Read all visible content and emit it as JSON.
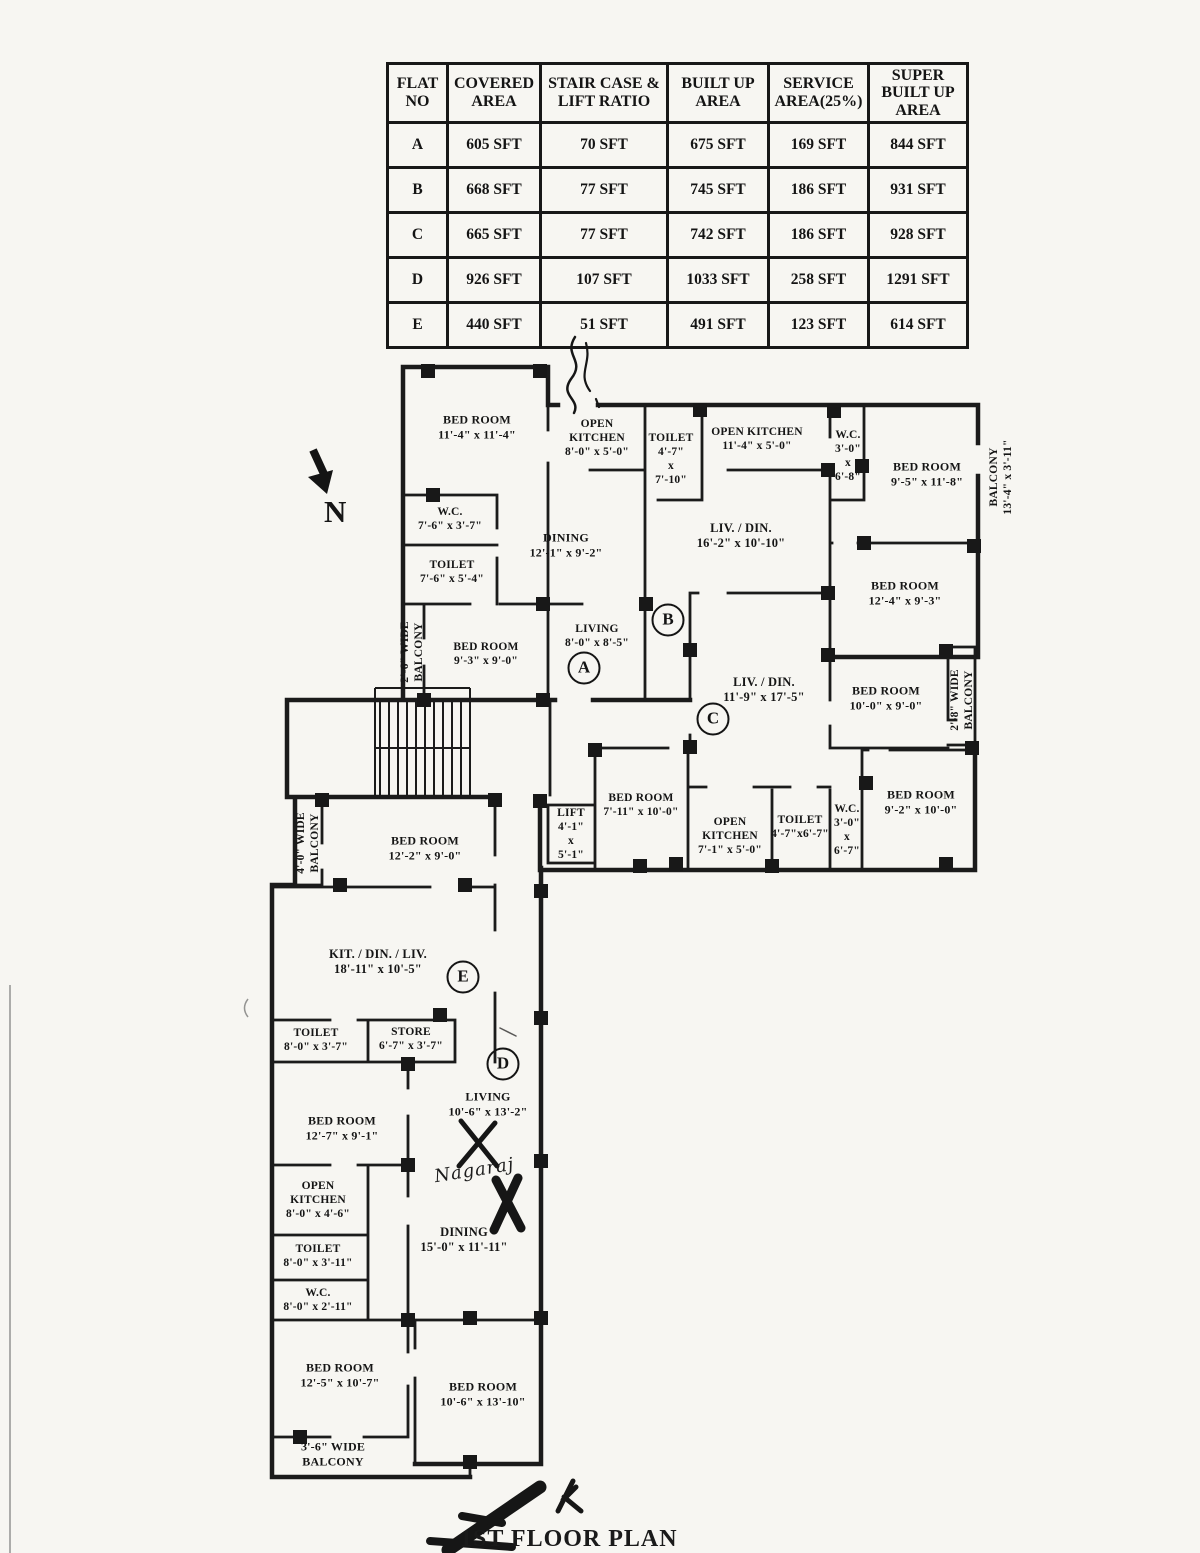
{
  "title": "1ST FLOOR PLAN",
  "compass": {
    "label": "N"
  },
  "annotations": {
    "signature": "Nagaraj"
  },
  "area_table": {
    "headers": [
      "FLAT NO",
      "COVERED AREA",
      "STAIR CASE & LIFT RATIO",
      "BUILT UP AREA",
      "SERVICE AREA(25%)",
      "SUPER BUILT UP AREA"
    ],
    "rows": [
      [
        "A",
        "605 SFT",
        "70 SFT",
        "675 SFT",
        "169 SFT",
        "844 SFT"
      ],
      [
        "B",
        "668 SFT",
        "77 SFT",
        "745 SFT",
        "186 SFT",
        "931 SFT"
      ],
      [
        "C",
        "665 SFT",
        "77 SFT",
        "742 SFT",
        "186 SFT",
        "928 SFT"
      ],
      [
        "D",
        "926 SFT",
        "107 SFT",
        "1033 SFT",
        "258 SFT",
        "1291 SFT"
      ],
      [
        "E",
        "440 SFT",
        "51 SFT",
        "491 SFT",
        "123 SFT",
        "614 SFT"
      ]
    ]
  },
  "flat_markers": [
    {
      "label": "A",
      "x": 584,
      "y": 668
    },
    {
      "label": "B",
      "x": 668,
      "y": 620
    },
    {
      "label": "C",
      "x": 713,
      "y": 719
    },
    {
      "label": "D",
      "x": 503,
      "y": 1064
    },
    {
      "label": "E",
      "x": 463,
      "y": 977
    }
  ],
  "rooms": [
    {
      "lines": [
        "BED ROOM",
        "11'-4\" x 11'-4\""
      ],
      "x": 477,
      "y": 427,
      "fs": 12
    },
    {
      "lines": [
        "OPEN",
        "KITCHEN",
        "8'-0\" x 5'-0\""
      ],
      "x": 597,
      "y": 438
    },
    {
      "lines": [
        "W.C.",
        "7'-6\" x 3'-7\""
      ],
      "x": 450,
      "y": 519
    },
    {
      "lines": [
        "TOILET",
        "7'-6\" x 5'-4\""
      ],
      "x": 452,
      "y": 572
    },
    {
      "lines": [
        "DINING",
        "12'-1\" x 9'-2\""
      ],
      "x": 566,
      "y": 545,
      "fs": 12
    },
    {
      "lines": [
        "2'-6\" WIDE",
        "BALCONY"
      ],
      "x": 412,
      "y": 652,
      "vert": true
    },
    {
      "lines": [
        "BED ROOM",
        "9'-3\" x 9'-0\""
      ],
      "x": 486,
      "y": 654
    },
    {
      "lines": [
        "LIVING",
        "8'-0\" x 8'-5\""
      ],
      "x": 597,
      "y": 636
    },
    {
      "lines": [
        "TOILET",
        "4'-7\"",
        "x",
        "7'-10\""
      ],
      "x": 671,
      "y": 459
    },
    {
      "lines": [
        "OPEN KITCHEN",
        "11'-4\" x 5'-0\""
      ],
      "x": 757,
      "y": 439
    },
    {
      "lines": [
        "W.C.",
        "3'-0\"",
        "x",
        "6'-8\""
      ],
      "x": 848,
      "y": 456
    },
    {
      "lines": [
        "BED ROOM",
        "9'-5\" x 11'-8\""
      ],
      "x": 927,
      "y": 474,
      "fs": 12
    },
    {
      "lines": [
        "BALCONY",
        "13'-4\" x 3'-11\""
      ],
      "x": 1001,
      "y": 477,
      "vert": true
    },
    {
      "lines": [
        "LIV. / DIN.",
        "16'-2\" x 10'-10\""
      ],
      "x": 741,
      "y": 536,
      "fs": 12.5
    },
    {
      "lines": [
        "BED ROOM",
        "12'-4\" x 9'-3\""
      ],
      "x": 905,
      "y": 593,
      "fs": 12
    },
    {
      "lines": [
        "LIV. / DIN.",
        "11'-9\" x 17'-5\""
      ],
      "x": 764,
      "y": 690,
      "fs": 12.5
    },
    {
      "lines": [
        "BED ROOM",
        "10'-0\" x 9'-0\""
      ],
      "x": 886,
      "y": 698,
      "fs": 12
    },
    {
      "lines": [
        "2'-8\" WIDE",
        "BALCONY"
      ],
      "x": 962,
      "y": 700,
      "vert": true
    },
    {
      "lines": [
        "BED ROOM",
        "9'-2\" x 10'-0\""
      ],
      "x": 921,
      "y": 802,
      "fs": 12
    },
    {
      "lines": [
        "W.C.",
        "3'-0\"",
        "x",
        "6'-7\""
      ],
      "x": 847,
      "y": 830
    },
    {
      "lines": [
        "TOILET",
        "4'-7\"x6'-7\""
      ],
      "x": 800,
      "y": 827
    },
    {
      "lines": [
        "OPEN",
        "KITCHEN",
        "7'-1\" x 5'-0\""
      ],
      "x": 730,
      "y": 836
    },
    {
      "lines": [
        "BED ROOM",
        "7'-11\" x 10'-0\""
      ],
      "x": 641,
      "y": 805
    },
    {
      "lines": [
        "LIFT",
        "4'-1\"",
        "x",
        "5'-1\""
      ],
      "x": 571,
      "y": 834
    },
    {
      "lines": [
        "4'-0\" WIDE",
        "BALCONY"
      ],
      "x": 308,
      "y": 843,
      "vert": true
    },
    {
      "lines": [
        "BED ROOM",
        "12'-2\" x 9'-0\""
      ],
      "x": 425,
      "y": 848,
      "fs": 12
    },
    {
      "lines": [
        "KIT. / DIN. / LIV.",
        "18'-11\" x 10'-5\""
      ],
      "x": 378,
      "y": 962,
      "fs": 12.5
    },
    {
      "lines": [
        "TOILET",
        "8'-0\" x 3'-7\""
      ],
      "x": 316,
      "y": 1040
    },
    {
      "lines": [
        "STORE",
        "6'-7\" x 3'-7\""
      ],
      "x": 411,
      "y": 1039
    },
    {
      "lines": [
        "LIVING",
        "10'-6\" x 13'-2\""
      ],
      "x": 488,
      "y": 1104,
      "fs": 12
    },
    {
      "lines": [
        "BED ROOM",
        "12'-7\" x 9'-1\""
      ],
      "x": 342,
      "y": 1128,
      "fs": 12
    },
    {
      "lines": [
        "OPEN",
        "KITCHEN",
        "8'-0\" x 4'-6\""
      ],
      "x": 318,
      "y": 1200
    },
    {
      "lines": [
        "TOILET",
        "8'-0\" x 3'-11\""
      ],
      "x": 318,
      "y": 1256
    },
    {
      "lines": [
        "W.C.",
        "8'-0\" x 2'-11\""
      ],
      "x": 318,
      "y": 1300
    },
    {
      "lines": [
        "DINING",
        "15'-0\" x 11'-11\""
      ],
      "x": 464,
      "y": 1240,
      "fs": 12.5
    },
    {
      "lines": [
        "BED ROOM",
        "12'-5\" x 10'-7\""
      ],
      "x": 340,
      "y": 1375,
      "fs": 12
    },
    {
      "lines": [
        "BED ROOM",
        "10'-6\" x 13'-10\""
      ],
      "x": 483,
      "y": 1394,
      "fs": 12
    },
    {
      "lines": [
        "3'-6\" WIDE",
        "BALCONY"
      ],
      "x": 333,
      "y": 1454,
      "fs": 12
    }
  ]
}
